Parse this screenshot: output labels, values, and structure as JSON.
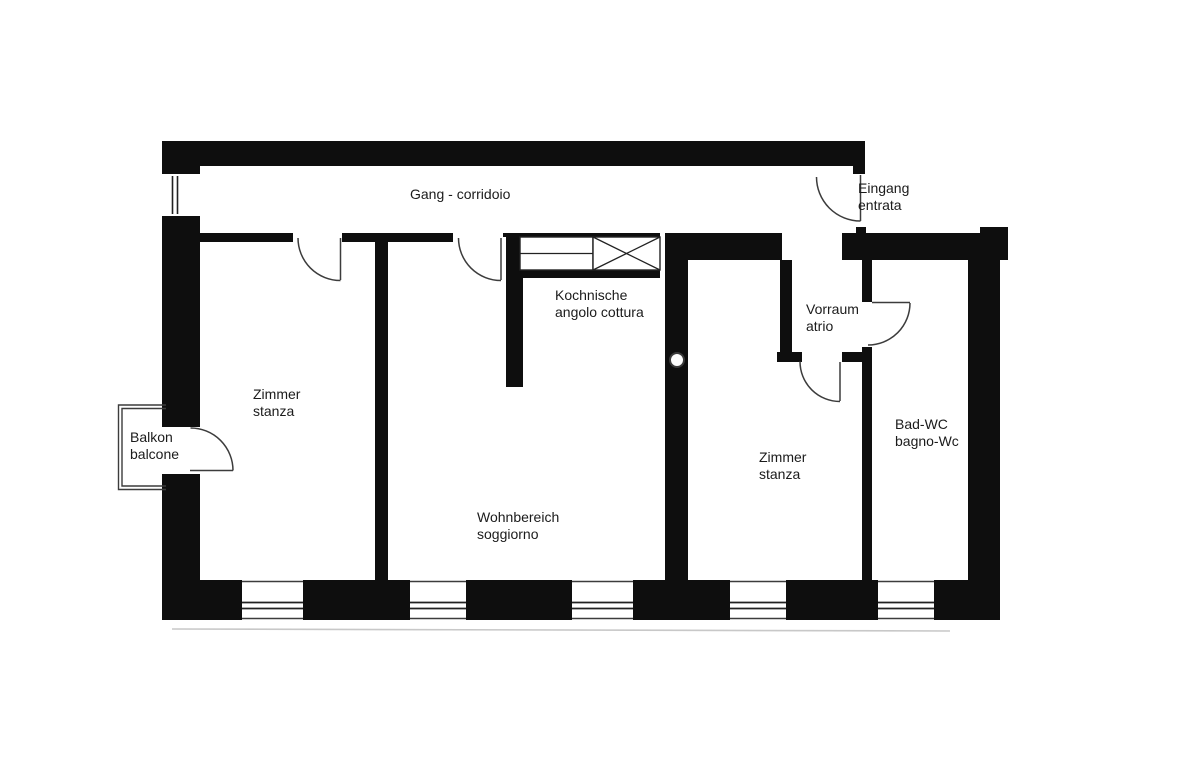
{
  "document": {
    "type": "floor-plan",
    "style": "scanned black-and-white apartment floor plan, German/Italian bilingual labels"
  },
  "colors": {
    "background": "#ffffff",
    "wall": "#0e0e0e",
    "line": "#3c3c3c",
    "faint_scan_line": "#c8c8c8",
    "text": "#1b1b1b"
  },
  "labels": {
    "gang": {
      "line1": "Gang - corridoio"
    },
    "eingang": {
      "line1": "Eingang",
      "line2": "entrata"
    },
    "kochnische": {
      "line1": "Kochnische",
      "line2": "angolo cottura"
    },
    "vorraum": {
      "line1": "Vorraum",
      "line2": "atrio"
    },
    "zimmer_left": {
      "line1": "Zimmer",
      "line2": "stanza"
    },
    "balkon": {
      "line1": "Balkon",
      "line2": "balcone"
    },
    "bad_wc": {
      "line1": "Bad-WC",
      "line2": "bagno-Wc"
    },
    "zimmer_right": {
      "line1": "Zimmer",
      "line2": "stanza"
    },
    "wohnbereich": {
      "line1": "Wohnbereich",
      "line2": "soggiorno"
    }
  },
  "symbols": {
    "doors": "quarter-circle-swing-arc",
    "windows": "double-line-in-wall",
    "kitchen_counter": "counter-with-shelf-line",
    "kitchen_appliance": "x-crossed-box",
    "flue": "circle-on-wall"
  }
}
